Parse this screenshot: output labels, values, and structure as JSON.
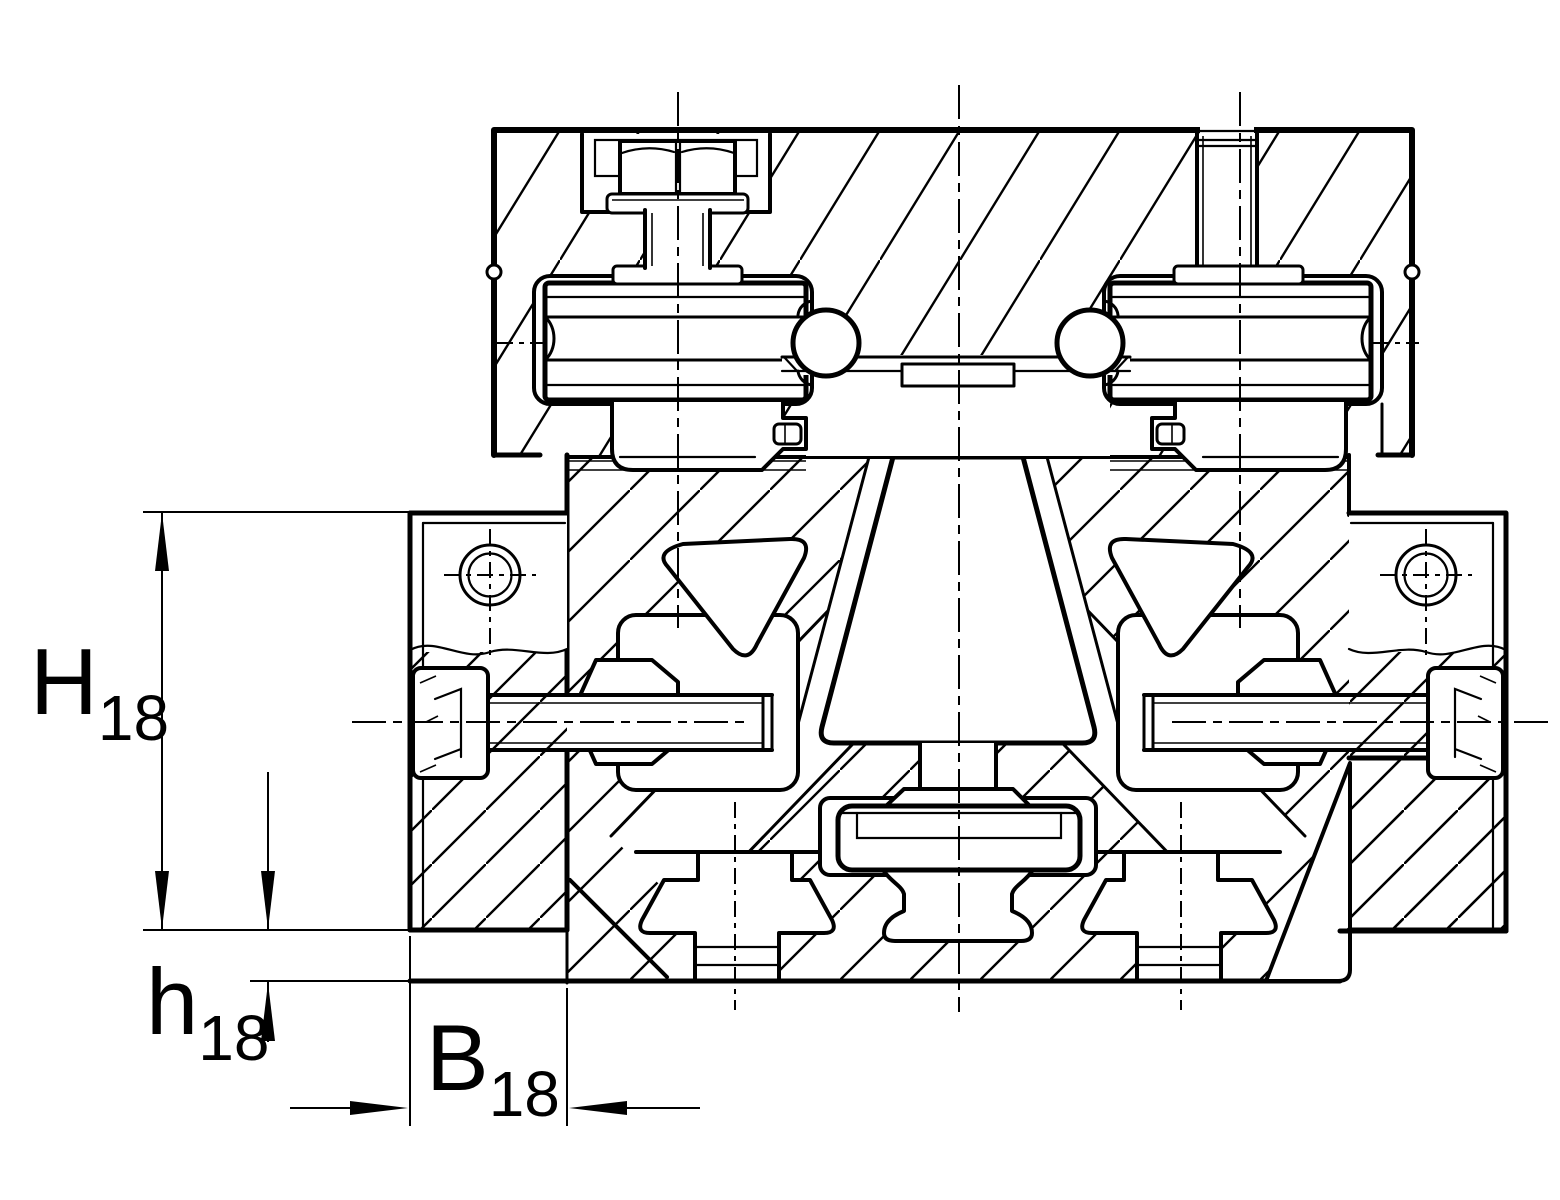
{
  "drawing": {
    "kind": "technical-section-drawing",
    "background": "#ffffff",
    "line_color": "#000000"
  },
  "labels": {
    "H": {
      "base": "H",
      "sub": "18"
    },
    "h": {
      "base": "h",
      "sub": "18"
    },
    "B": {
      "base": "B",
      "sub": "18"
    }
  }
}
